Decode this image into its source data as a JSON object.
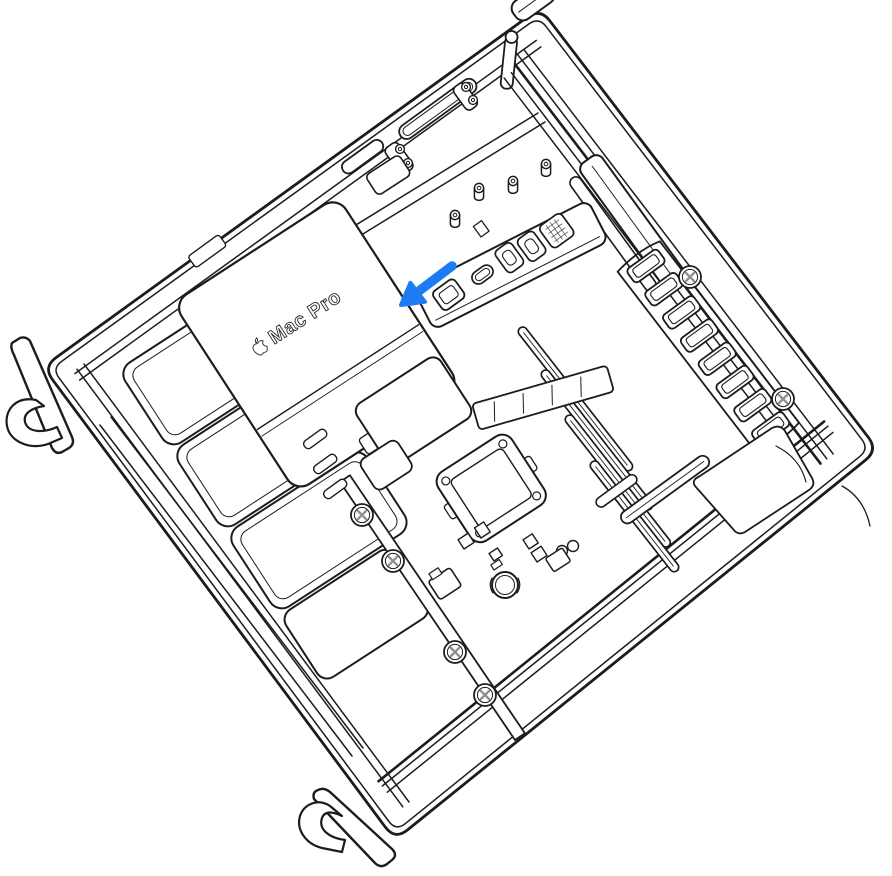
{
  "illustration": {
    "device_label": {
      "icon": "apple-logo-icon",
      "text": "Mac Pro"
    },
    "annotation_arrow": {
      "icon": "arrow-down-left-icon",
      "direction": "down-left",
      "color": "#1E7CF3"
    },
    "colors": {
      "background": "#ffffff",
      "line": "#1c1c1c",
      "screw_cross": "#8f8f8f"
    }
  }
}
